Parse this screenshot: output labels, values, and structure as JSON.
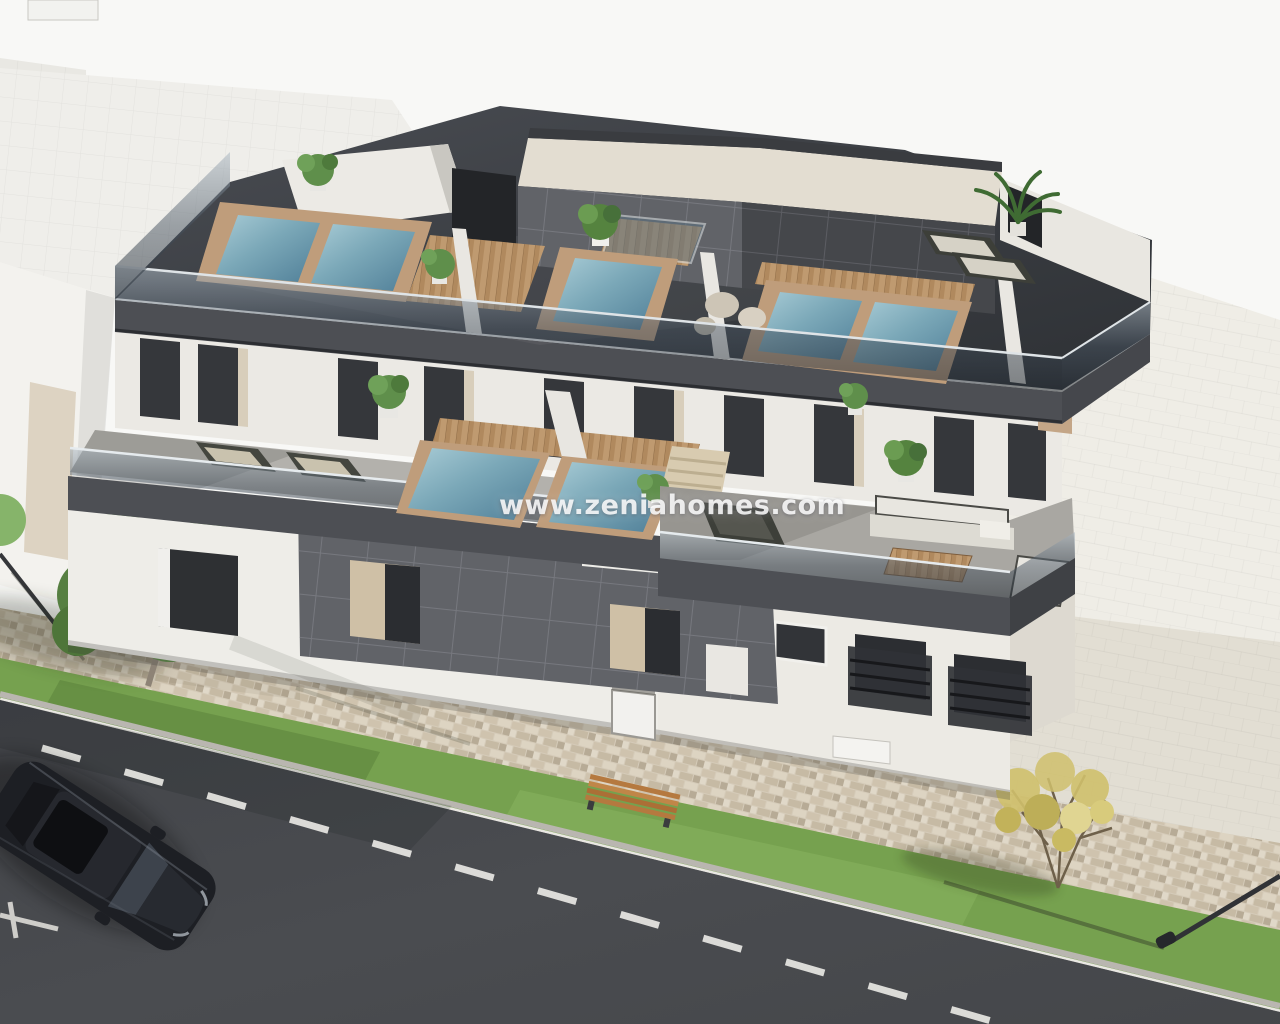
{
  "watermark": {
    "text": "www.zeniahomes.com",
    "color": "#ffffff"
  },
  "palette": {
    "sky": "#f8f8f6",
    "backdrop": "#efede6",
    "plaza": "#e2ded3",
    "neighbor_roof": "#efeeea",
    "neighbor_wall": "#f2f1ed",
    "neighbor_band": "#ddd3c2",
    "wall_white": "#eeede8",
    "wall_shade": "#e0ded7",
    "fascia": "#4d4f54",
    "fascia_dark": "#3f4145",
    "roof_floor": "#3e4146",
    "glass": "#2e3440",
    "tile_panel": "#616368",
    "tile_joint": "#7a7c82",
    "window_glass": "#323438",
    "window_reveal": "#d8cebb",
    "water": "#7ba8b8",
    "water_deep": "#53829b",
    "coping": "#bf9d7b",
    "wood": "#b98e66",
    "terrace": "#b3b1ac",
    "terrace_right": "#a9a7a2",
    "grass": "#76a14f",
    "cobble": "#d5cbb9",
    "asphalt": "#47494d",
    "curb": "#e9e7e2",
    "road_marking": "#ecebe7",
    "car_body": "#1d1f24",
    "tree_green": "#5f8f4b",
    "tree_autumn": "#cfc06c",
    "bench_wood": "#b5793f",
    "cushion_white": "#e8e6e0",
    "stairs_beige": "#d8cbb0"
  }
}
